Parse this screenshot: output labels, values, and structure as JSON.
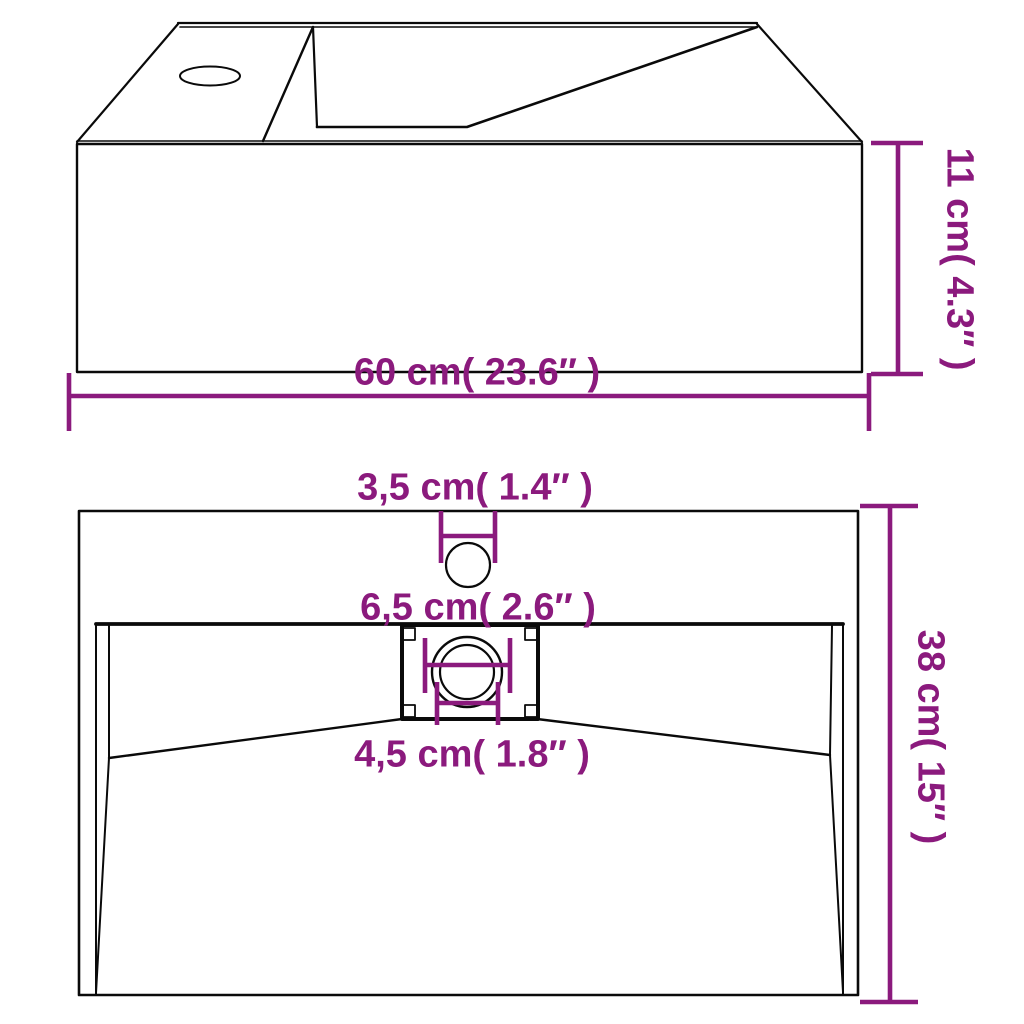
{
  "diagram": {
    "type": "product-dimension-drawing",
    "subject": "wall-mounted bathroom basin, perspective view and plan view with measurements",
    "colors": {
      "accent": "#8b1a7d",
      "line": "#0a0a0a",
      "background": "#ffffff"
    },
    "top_view": {
      "width_label": "60 cm( 23.6″ )",
      "height_label": "11 cm( 4.3″ )"
    },
    "bottom_view": {
      "faucet_hole_label": "3,5 cm( 1.4″ )",
      "drain_recess_label": "6,5 cm( 2.6″ )",
      "drain_hole_label": "4,5 cm( 1.8″ )",
      "depth_label": "38 cm( 15″ )"
    }
  }
}
